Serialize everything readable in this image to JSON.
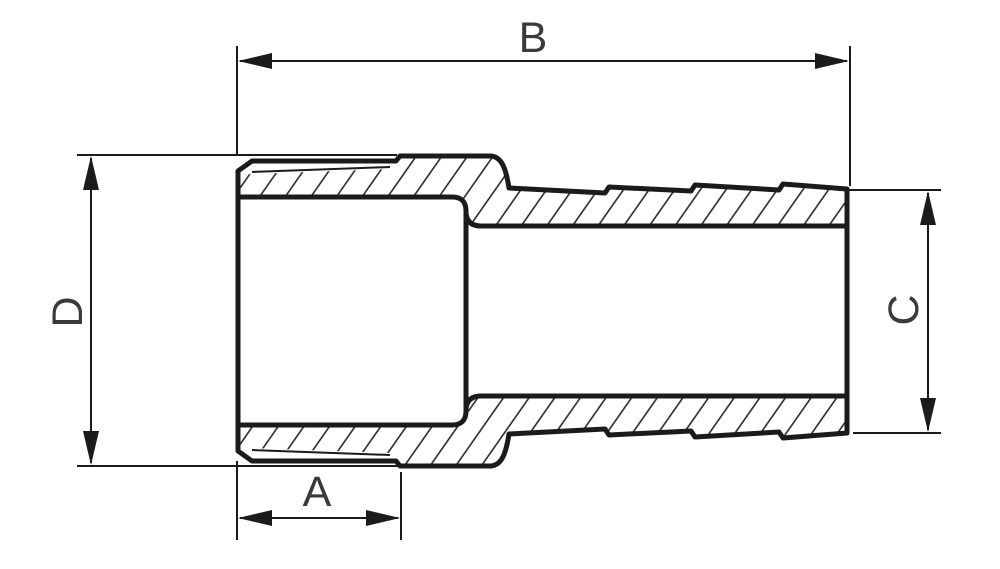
{
  "figure": {
    "type": "technical-drawing-cross-section",
    "view": "side section with hatching"
  },
  "colors": {
    "line": "#1b1b1b",
    "text": "#3a3a3a",
    "background": "#ffffff"
  },
  "dimensions": {
    "b": {
      "label": "B",
      "orientation": "horizontal",
      "position": "top"
    },
    "d": {
      "label": "D",
      "orientation": "vertical",
      "position": "left"
    },
    "c": {
      "label": "C",
      "orientation": "vertical",
      "position": "right"
    },
    "a": {
      "label": "A",
      "orientation": "horizontal",
      "position": "bottom"
    }
  }
}
